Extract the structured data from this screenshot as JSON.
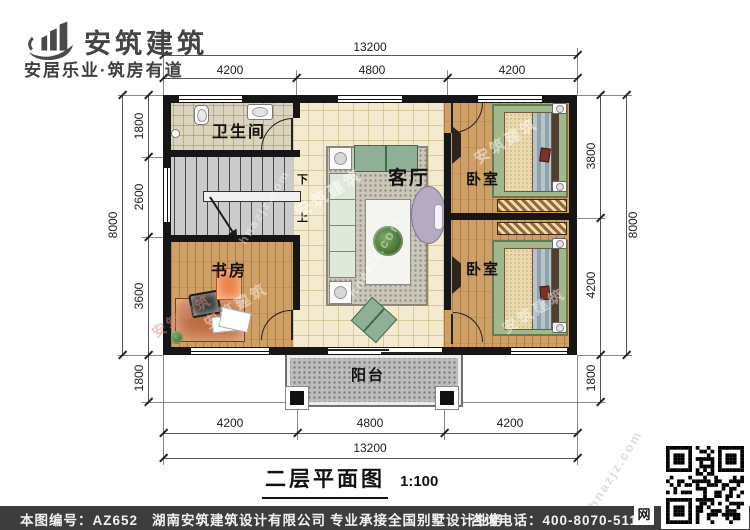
{
  "brand": {
    "name": "安筑建筑",
    "tagline": "安居乐业·筑房有道"
  },
  "watermark": {
    "brand": "安筑建筑",
    "site": "hnazjz.com"
  },
  "dims": {
    "top_total": "13200",
    "top_segments": [
      "4200",
      "4800",
      "4200"
    ],
    "bottom_segments": [
      "4200",
      "4800",
      "4200"
    ],
    "bottom_total": "13200",
    "left_total": "8000",
    "left_segments": [
      "1800",
      "2600",
      "3600"
    ],
    "left_balcony": "1800",
    "right_total": "8000",
    "right_segments": [
      "3800",
      "4200"
    ],
    "right_balcony": "1800"
  },
  "rooms": {
    "bathroom": "卫生间",
    "living": "客厅",
    "bedroom_top": "卧室",
    "bedroom_bottom": "卧室",
    "study": "书房",
    "balcony": "阳台"
  },
  "stairs": {
    "down": "下",
    "up": "上"
  },
  "title": {
    "text": "二层平面图",
    "scale": "1:100"
  },
  "footer": {
    "number_label": "本图编号：AZ652",
    "company": "湖南安筑建筑设计有限公司",
    "service": "专业承接全国别墅设计业务",
    "phone": "咨询电话：400-8070-511",
    "web_badge": "网"
  },
  "colors": {
    "brand_gray": "#454545",
    "wall": "#161616",
    "wood_floor": "#cfa065",
    "footer_bg": "#3d3d3d"
  }
}
